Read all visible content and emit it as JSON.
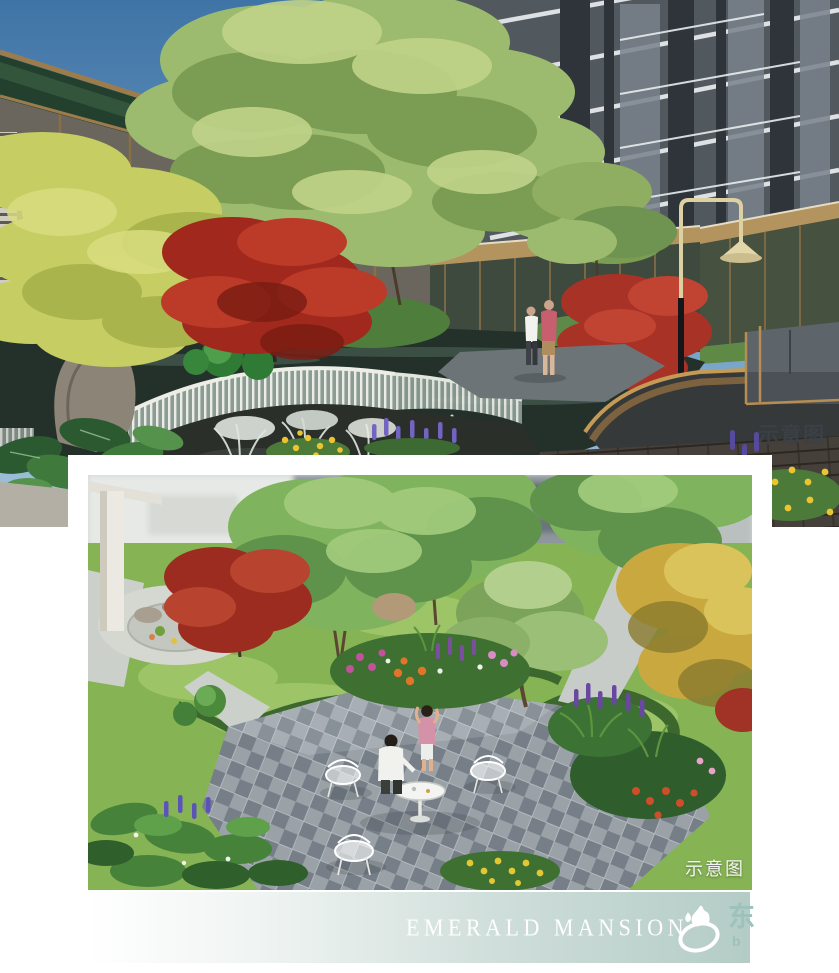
{
  "top_render": {
    "caption": "示意图",
    "scene": "courtyard-waterfall-garden-render",
    "sky_color": "#4a7cab",
    "maple_color": "#b23726",
    "water_color": "#24312b"
  },
  "bottom_render": {
    "caption": "示意图",
    "scene": "garden-plaza-render",
    "paving_color": "#8d969c",
    "lawn_color": "#86b354"
  },
  "footer": {
    "title": "EMERALD MANSION",
    "bar_color_left": "#ffffff",
    "bar_color_right": "#b4ccc6",
    "title_color": "#fdfefd",
    "watermark": {
      "icon": "flame-ring-logo-icon",
      "char": "东",
      "subtext": "b",
      "color": "#9cc2ba"
    }
  }
}
